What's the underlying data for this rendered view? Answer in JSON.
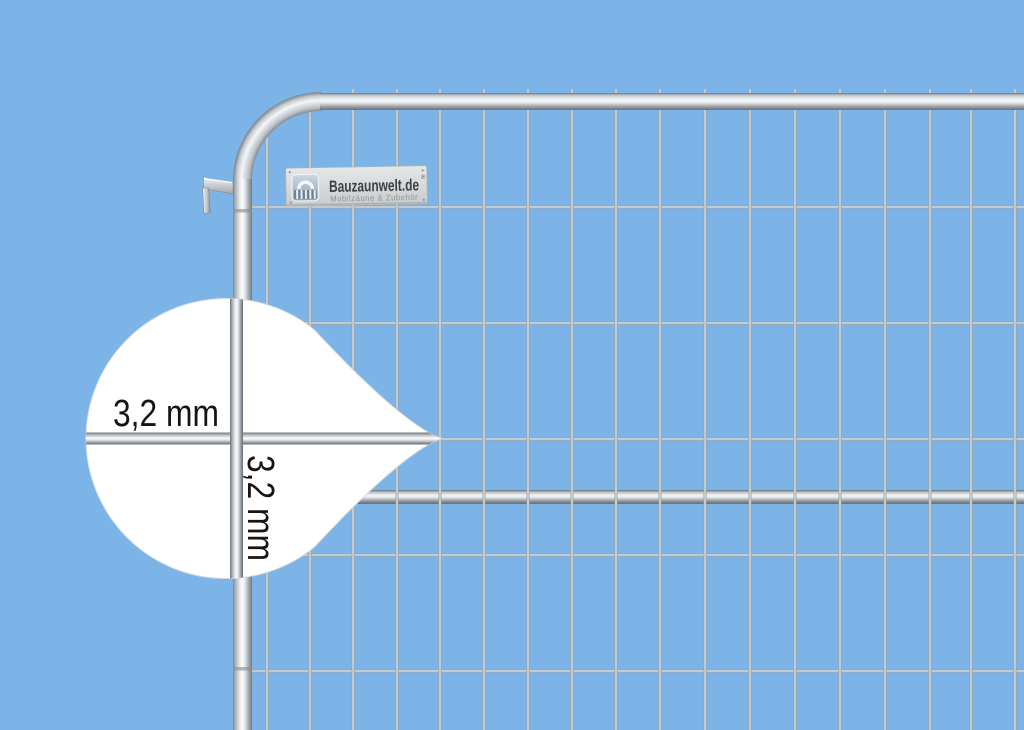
{
  "scene": {
    "type": "product-photo",
    "subject": "Mobile construction fence panel (Bauzaun) with magnifier callout showing wire thickness",
    "background_color": "#7cb4e7"
  },
  "brand_plate": {
    "name": "Bauzaunwelt.de",
    "registered_mark": "®",
    "tagline": "Mobilzäune & Zubehör"
  },
  "magnifier_callout": {
    "horizontal_wire_label": "3,2 mm",
    "vertical_wire_label": "3,2 mm"
  },
  "palette": {
    "background": "#7cb4e7",
    "metal_light": "#f6f8f9",
    "metal_mid": "#c6ccd0",
    "metal_dark": "#757c82",
    "bubble_fill": "#ffffff",
    "label_text_color": "#151515",
    "brand_text_color": "#3d4144",
    "tagline_text_color": "#8e9598"
  }
}
